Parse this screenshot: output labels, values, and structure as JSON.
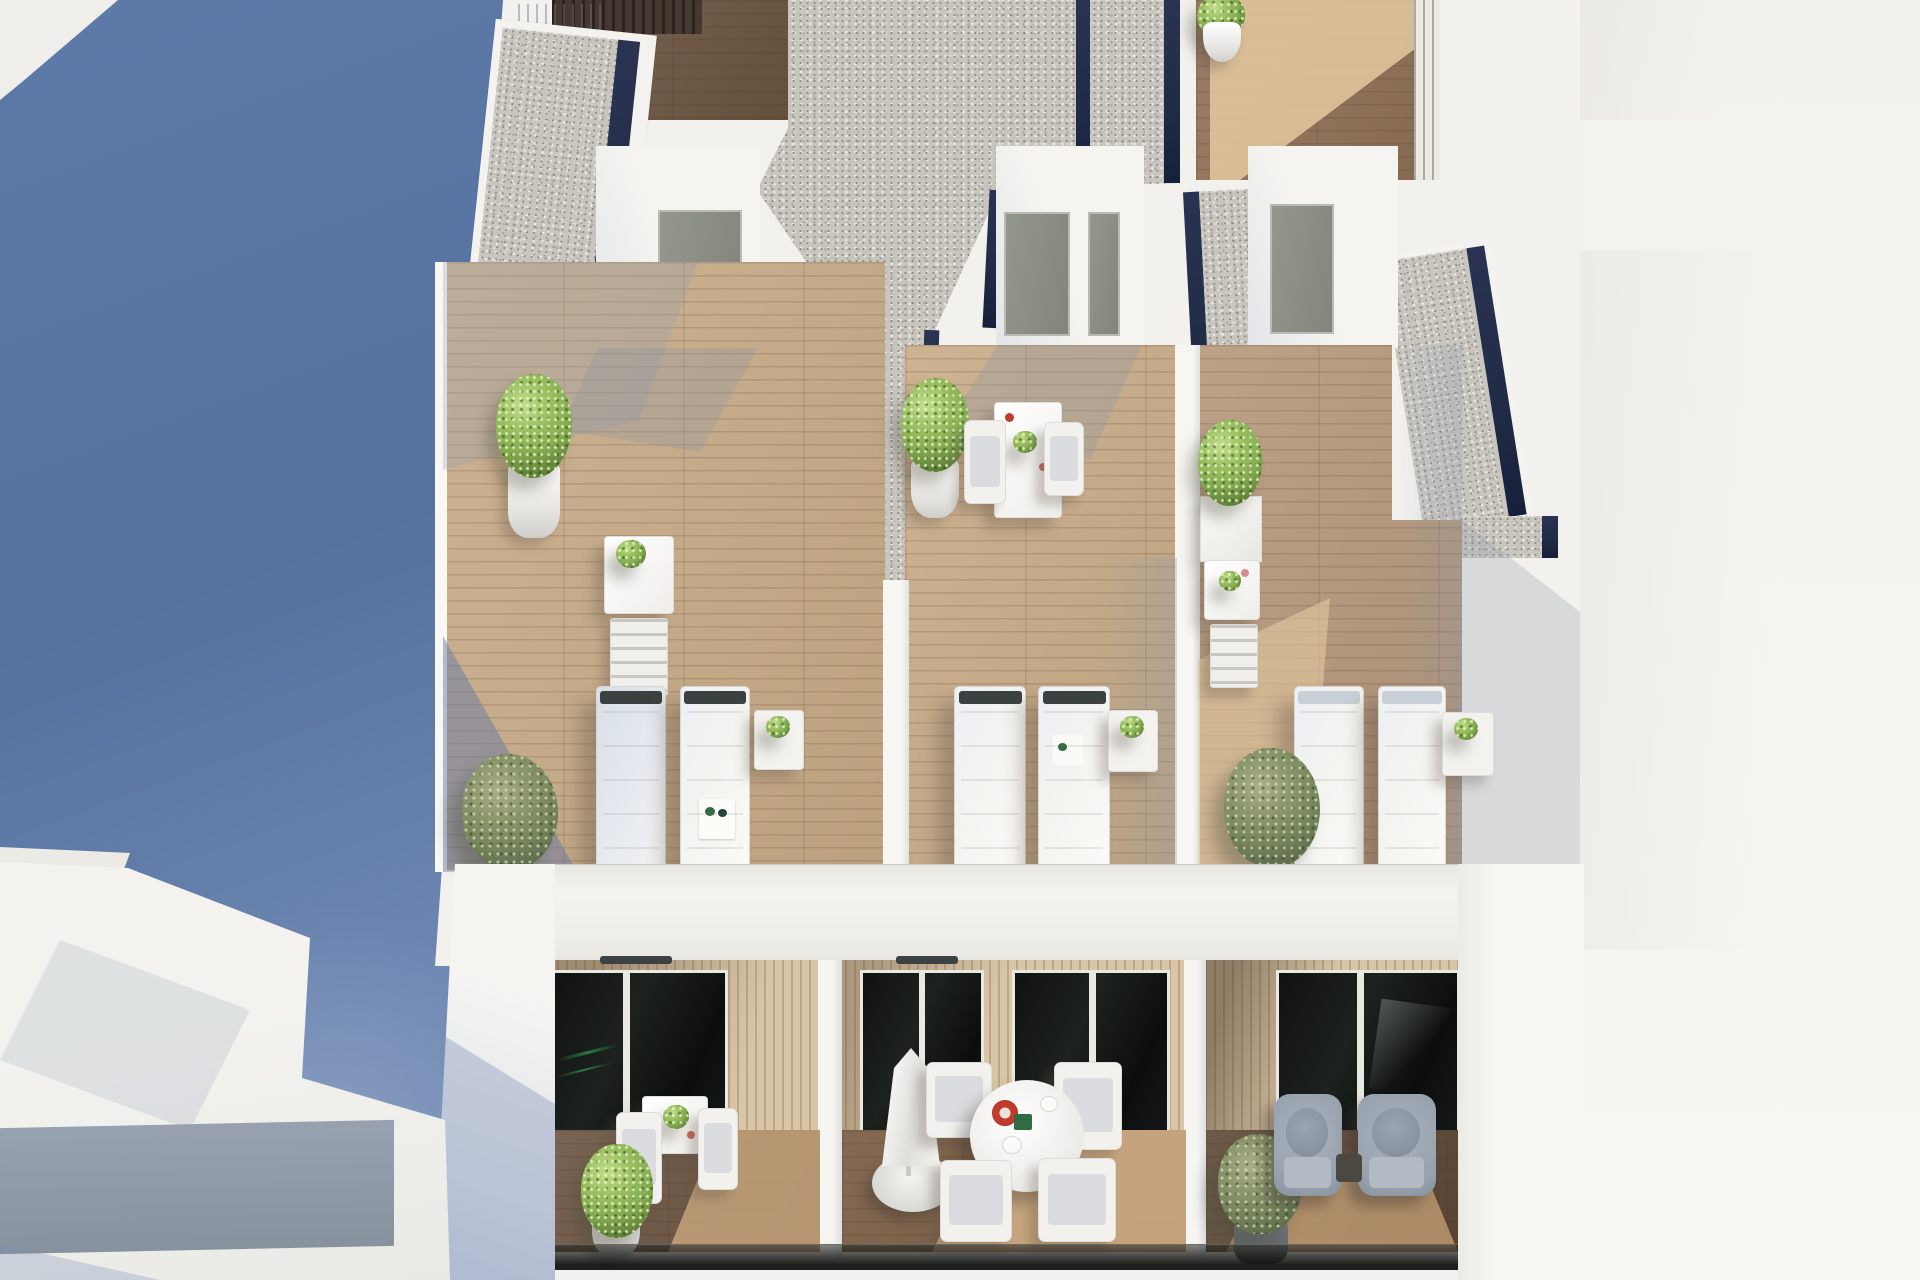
{
  "meta": {
    "type": "architectural-3d-render",
    "subject": "Aerial view of a modern white apartment building: rooftop terraces with sun loungers above a row of balconies",
    "visible_text": "none"
  },
  "palette": {
    "blue-shadow-1": "#5e7aa9",
    "blue-shadow-2": "#54719f",
    "blue-shadow-3": "#8096bf",
    "wall-white": "#f2f1ed",
    "wall-bright": "#f7f6f2",
    "wall-shade": "#c9d1dd",
    "gravel-base": "#c8c5bf",
    "navy": "#202b46",
    "wood-dark": "#6a5340",
    "wood-mid": "#8f7056",
    "wood-light": "#c8ab87",
    "wood-sun": "#e4c9a0",
    "slat-wall": "#d9c6a6",
    "glass-dark": "#141815",
    "glass-green": "#2f8f4e",
    "door-olive": "#8f9285",
    "plant-bright": "#84ab50",
    "plant-olive": "#76845b",
    "furniture-white": "#f2f1ee",
    "cushion-gray": "#9aa5b1",
    "accent-red": "#c23a2c"
  },
  "scene": {
    "left_plane": "deep blue shadow plane with white building fragments top-left and bottom-left",
    "right_plane": "bright overexposed white wall",
    "rooftop": {
      "gravel_roof_strips": 5,
      "terraces": [
        {
          "id": "left",
          "items": [
            "entrance-hut-with-door",
            "potted-tree",
            "console-table-with-plant",
            "folding-chair",
            "sun-lounger",
            "sun-lounger",
            "side-table-with-plant",
            "olive-bush"
          ]
        },
        {
          "id": "middle",
          "items": [
            "entrance-hut-with-two-doors",
            "potted-plant",
            "bistro-table-with-two-chairs",
            "sun-lounger",
            "sun-lounger",
            "side-table-with-plant"
          ]
        },
        {
          "id": "right",
          "items": [
            "entrance-hut-with-door",
            "box-planter",
            "console-table-with-plant",
            "folding-chair",
            "sun-lounger",
            "sun-lounger",
            "side-table-with-plant",
            "olive-bush"
          ]
        }
      ]
    },
    "balconies": [
      {
        "id": "left",
        "items": [
          "dark-glass-slider",
          "square-dining-table",
          "two-chairs",
          "potted-bush"
        ]
      },
      {
        "id": "middle",
        "items": [
          "dark-glass-sliders",
          "closed-parasol-with-base",
          "round-dining-table",
          "four-chairs",
          "red-plate"
        ]
      },
      {
        "id": "right",
        "items": [
          "dark-glass-slider",
          "two-lounge-armchairs",
          "dark-side-table",
          "potted-olive-tree"
        ]
      }
    ],
    "materials": [
      "white render walls",
      "timber decking",
      "gravel flat roofs",
      "navy drainage edges",
      "dark glazing",
      "vertical timber cladding",
      "glass balustrade"
    ]
  }
}
